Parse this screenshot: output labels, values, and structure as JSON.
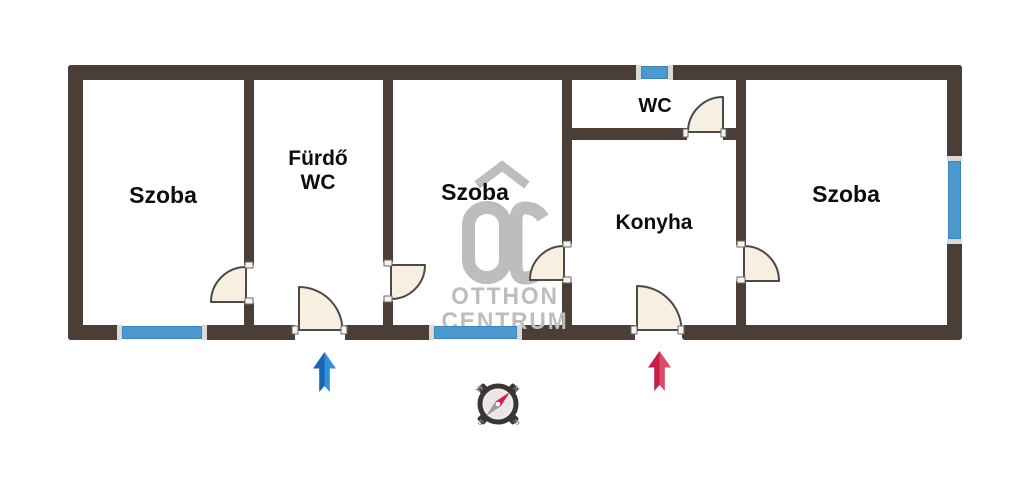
{
  "rooms": {
    "szoba_left": "Szoba",
    "furdo_line1": "Fürdő",
    "furdo_line2": "WC",
    "szoba_middle": "Szoba",
    "wc": "WC",
    "konyha": "Konyha",
    "szoba_right": "Szoba"
  },
  "watermark": {
    "logo": "OC",
    "line1": "OTTHON",
    "line2": "CENTRUM"
  },
  "compass": {
    "north": "N",
    "east": "E",
    "south": "S",
    "west": "W"
  },
  "colors": {
    "wall": "#4a3e36",
    "window": "#4a99cf",
    "door_fill": "#f7f0e1",
    "blue_arrow_dark": "#1c64b4",
    "blue_arrow_light": "#3191d6",
    "red_arrow_dark": "#c51f48",
    "red_arrow_light": "#de4a66",
    "watermark_gray": "#bdbdbd"
  }
}
